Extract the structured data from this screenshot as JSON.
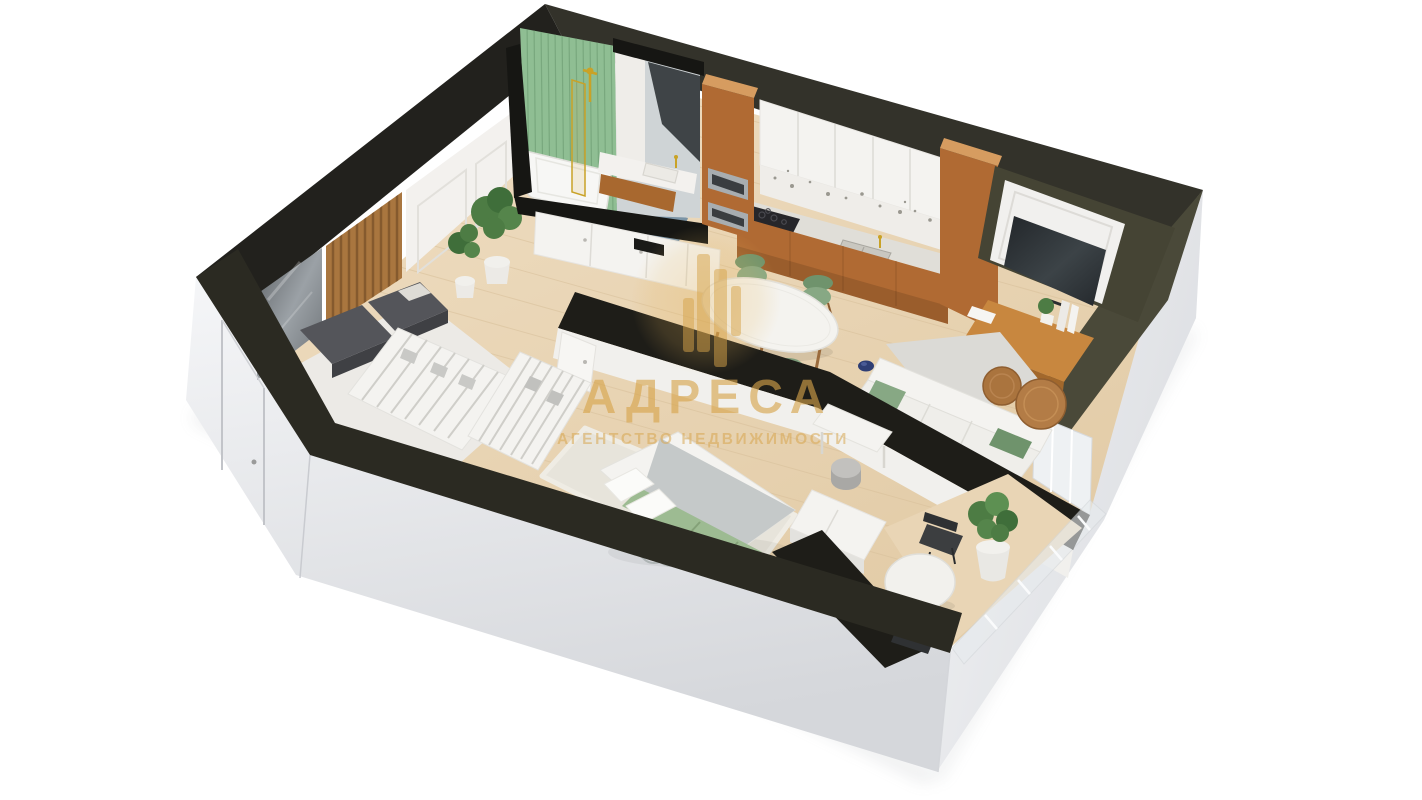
{
  "watermark": {
    "brand": "АДРЕСА",
    "tagline": "АГЕНТСТВО НЕДВИЖИМОСТИ",
    "icon": "buildings-bars-icon",
    "color": "#d7a44a"
  },
  "palette": {
    "background": "#ffffff",
    "wall_top_dark": "#2b2a22",
    "wall_top_olive": "#4a4939",
    "wall_top_brown": "#33322a",
    "wall_interior_black": "#1e1d18",
    "exterior_face_light": "#f4f5f7",
    "exterior_face_dark": "#d7d9dc",
    "floor_wood": "#ecd9bc",
    "floor_wood_line": "#d9c19c",
    "kitchen_wood": "#b06a33",
    "kitchen_wood_light": "#d69c60",
    "tile_green": "#8fbe93",
    "tile_green_line": "#79a87e",
    "sage": "#87a884",
    "sage_dark": "#6f936c",
    "gold_brass": "#c9a227",
    "watermark_gold": "#d7a44a",
    "marble": "#efede9",
    "marble_floor": "#eceae6",
    "rug_gray": "#dbdad6",
    "rug_beige": "#e7e4db",
    "bench_gray": "#54555a",
    "plant_green": "#4d7c44",
    "plant_green_dark": "#3f6e3a",
    "chair_dark": "#3c3e40",
    "bath_floor_blue": "#7b94a6",
    "blanket_gray": "#c5c9c9",
    "throw_green": "#9dbb92",
    "white_furniture": "#f4f3f0",
    "white_wall": "#f3f1ee",
    "tv_screen": "#2b3034",
    "wood_table": "#b37c46"
  },
  "scene": {
    "type": "3d-cutaway-floor-plan-render",
    "view": "axonometric perspective, white background",
    "rooms": [
      {
        "name": "entry-hall",
        "items": [
          "front-door",
          "tall-mirror",
          "wood-slat-panel",
          "bench-cushions",
          "marble-block",
          "potted-plants",
          "marble-floor",
          "paneled-wall"
        ]
      },
      {
        "name": "bathroom",
        "items": [
          "green-tile-wall",
          "marble-mirror-wall",
          "bathtub",
          "brass-glass-shower-screen",
          "shower-fixture",
          "vanity-counter-sink",
          "wood-cabinet",
          "blue-tile-floor"
        ]
      },
      {
        "name": "hall-closet",
        "items": [
          "white-closet-doors",
          "open-wardrobe-shelves"
        ]
      },
      {
        "name": "kitchen",
        "items": [
          "tall-oven-column",
          "double-oven",
          "white-upper-cabinets",
          "marble-backsplash",
          "marble-counter",
          "cooktop",
          "double-sink",
          "wood-base-cabinets",
          "tall-pantry-column"
        ]
      },
      {
        "name": "living-dining",
        "items": [
          "oval-marble-dining-table",
          "four-sage-chairs",
          "sofa-with-green-pillows",
          "gray-area-rug",
          "two-round-coffee-tables",
          "tv-on-paneled-niche-wall",
          "wood-window-seat-bench",
          "books",
          "small-plant",
          "blue-floor-vase",
          "window"
        ]
      },
      {
        "name": "bedroom",
        "items": [
          "double-bed",
          "white-pillows",
          "gray-blanket",
          "green-throw",
          "shag-rug",
          "vanity-desk",
          "pouf",
          "white-dresser"
        ]
      },
      {
        "name": "balcony",
        "items": [
          "round-white-table",
          "two-dark-chairs",
          "large-potted-plant",
          "glass-balustrade"
        ]
      }
    ]
  }
}
